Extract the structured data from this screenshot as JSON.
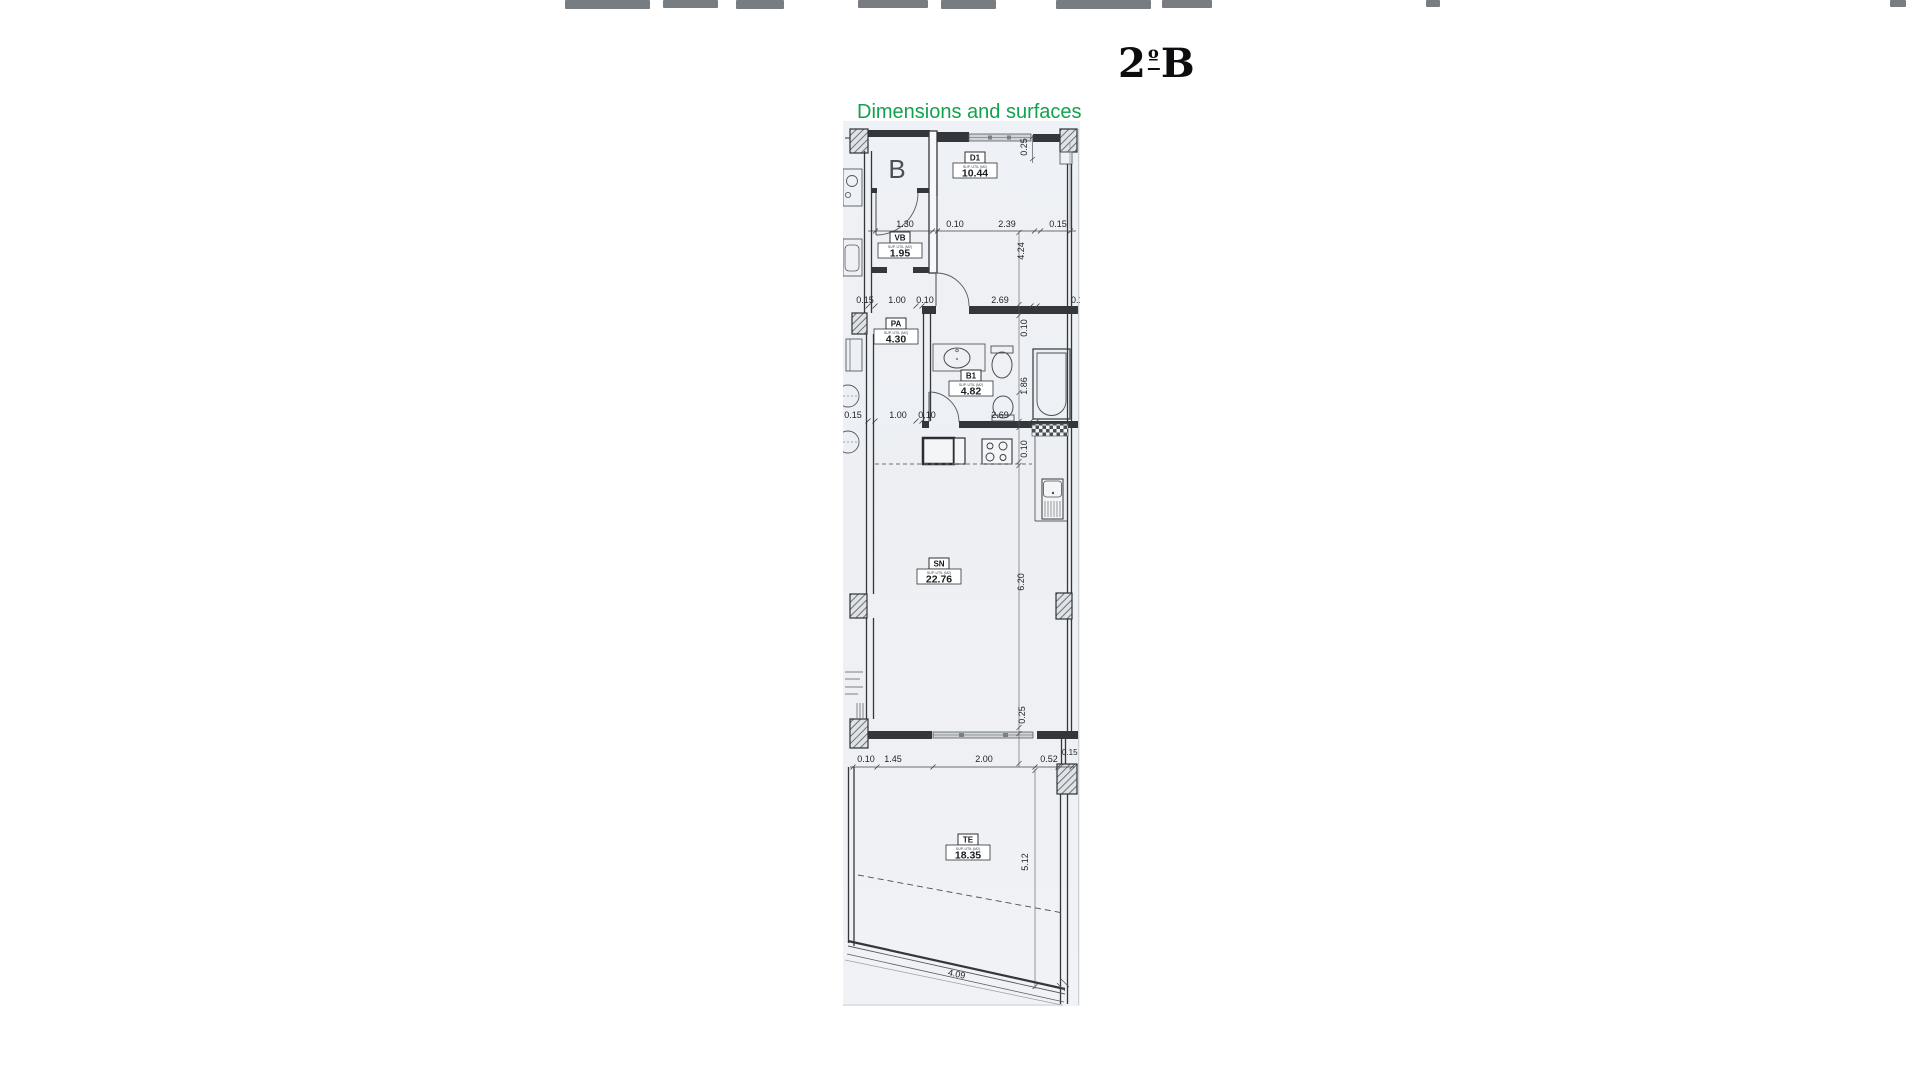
{
  "header": {
    "title_parts": [
      "2",
      "º",
      "B"
    ],
    "subtitle": "Dimensions and surfaces"
  },
  "colors": {
    "subtitle_green": "#12A24D",
    "wall_dark": "#33373B",
    "paper": "#EEF1F5"
  },
  "plan": {
    "apartment_label": "B",
    "rooms": [
      {
        "code": "D1",
        "caption": "SUP. UTIL (M2)",
        "area": "10.44"
      },
      {
        "code": "VB",
        "caption": "SUP. UTIL (M2)",
        "area": "1.95"
      },
      {
        "code": "PA",
        "caption": "SUP. UTIL (M2)",
        "area": "4.30"
      },
      {
        "code": "B1",
        "caption": "SUP. UTIL (M2)",
        "area": "4.82"
      },
      {
        "code": "SN",
        "caption": "SUP. UTIL (M2)",
        "area": "22.76"
      },
      {
        "code": "TE",
        "caption": "SUP. UTIL (M2)",
        "area": "18.35"
      }
    ],
    "dims": {
      "row1": [
        "1.30",
        "0.10",
        "2.39",
        "0.15"
      ],
      "row2": [
        "0.15",
        "1.00",
        "0.10",
        "2.69",
        "0.15"
      ],
      "row3": [
        "0.15",
        "1.00",
        "0.10",
        "2.69"
      ],
      "row4": [
        "0.10",
        "1.45",
        "2.00",
        "0.52",
        "0.15"
      ],
      "v": [
        "0.25",
        "4.24",
        "0.10",
        "1.86",
        "0.10",
        "6.20",
        "0.25",
        "5.12"
      ],
      "slant": "4.09"
    }
  }
}
